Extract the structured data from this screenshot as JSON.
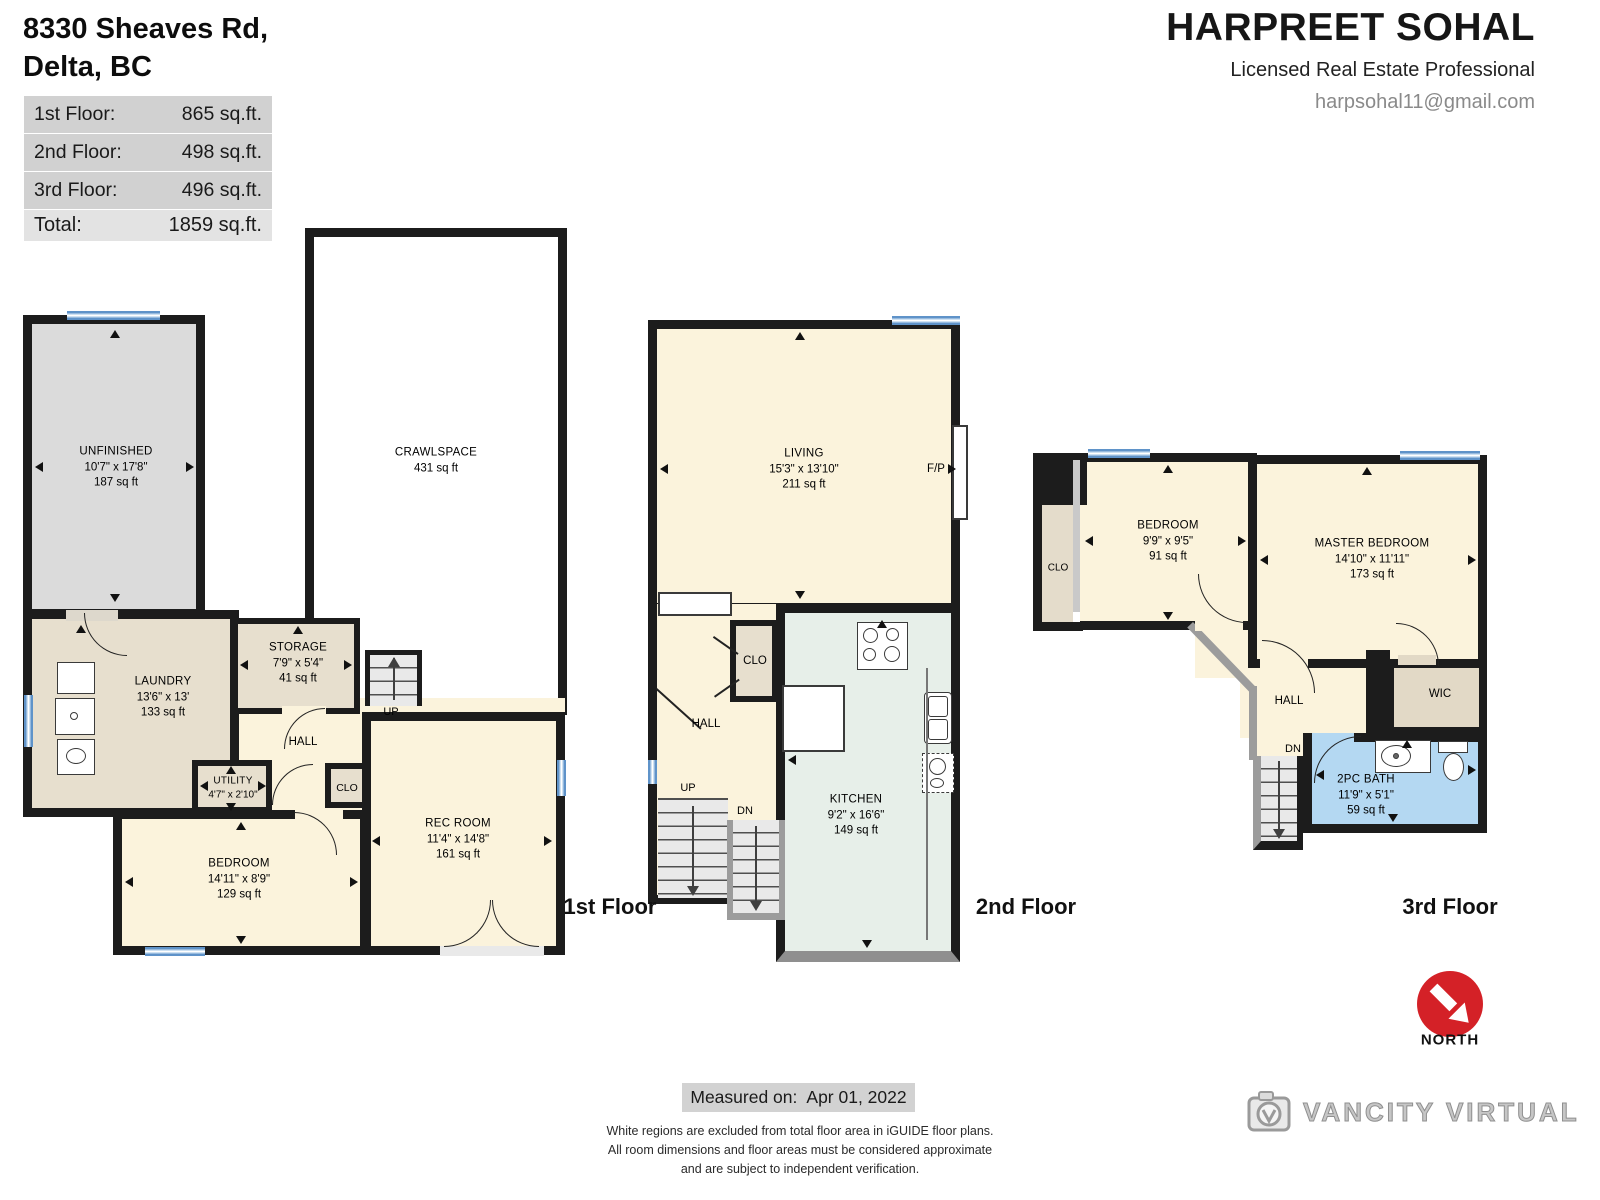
{
  "title": {
    "line1": "8330 Sheaves Rd,",
    "line2": "Delta, BC"
  },
  "area_table": {
    "rows": [
      {
        "label": "1st Floor:",
        "value": "865 sq.ft."
      },
      {
        "label": "2nd Floor:",
        "value": "498 sq.ft."
      },
      {
        "label": "3rd Floor:",
        "value": "496 sq.ft."
      }
    ],
    "total_label": "Total:",
    "total_value": "1859 sq.ft."
  },
  "agent": {
    "name": "HARPREET SOHAL",
    "title": "Licensed Real Estate Professional",
    "email": "harpsohal11@gmail.com"
  },
  "floor1": {
    "label": "1st Floor",
    "rooms": {
      "unfinished": {
        "name": "UNFINISHED",
        "dims": "10'7\" x 17'8\"",
        "area": "187 sq ft"
      },
      "crawlspace": {
        "name": "CRAWLSPACE",
        "area": "431 sq ft"
      },
      "laundry": {
        "name": "LAUNDRY",
        "dims": "13'6\" x 13'",
        "area": "133 sq ft"
      },
      "storage": {
        "name": "STORAGE",
        "dims": "7'9\" x 5'4\"",
        "area": "41 sq ft"
      },
      "utility": {
        "name": "UTILITY",
        "dims": "4'7\" x 2'10\""
      },
      "bedroom": {
        "name": "BEDROOM",
        "dims": "14'11\" x 8'9\"",
        "area": "129 sq ft"
      },
      "recroom": {
        "name": "REC ROOM",
        "dims": "11'4\" x 14'8\"",
        "area": "161 sq ft"
      }
    },
    "labels": {
      "hall": "HALL",
      "clo": "CLO",
      "up": "UP"
    }
  },
  "floor2": {
    "label": "2nd Floor",
    "rooms": {
      "living": {
        "name": "LIVING",
        "dims": "15'3\" x 13'10\"",
        "area": "211 sq ft"
      },
      "kitchen": {
        "name": "KITCHEN",
        "dims": "9'2\" x 16'6\"",
        "area": "149 sq ft"
      }
    },
    "labels": {
      "hall": "HALL",
      "clo": "CLO",
      "up": "UP",
      "dn": "DN",
      "fp": "F/P"
    }
  },
  "floor3": {
    "label": "3rd Floor",
    "rooms": {
      "bedroom": {
        "name": "BEDROOM",
        "dims": "9'9\" x 9'5\"",
        "area": "91 sq ft"
      },
      "master": {
        "name": "MASTER BEDROOM",
        "dims": "14'10\" x 11'11\"",
        "area": "173 sq ft"
      },
      "bath": {
        "name": "2PC BATH",
        "dims": "11'9\" x 5'1\"",
        "area": "59 sq ft"
      }
    },
    "labels": {
      "hall": "HALL",
      "clo": "CLO",
      "wic": "WIC",
      "dn": "DN"
    }
  },
  "compass": {
    "label": "NORTH"
  },
  "footer": {
    "measured_label": "Measured on:",
    "measured_value": "Apr 01, 2022",
    "disclaimer1": "White regions are excluded from total floor area in iGUIDE floor plans.",
    "disclaimer2": "All room dimensions and floor areas must be considered approximate",
    "disclaimer3": "and are subject to independent verification."
  },
  "branding": {
    "logo_text": "VANCITY VIRTUAL"
  },
  "colors": {
    "wall": "#1c1c1c",
    "window_blue": "#6FA0D4",
    "room_cream": "#FBF3DC",
    "room_tan": "#E7DFCE",
    "room_gray": "#DBDBDB",
    "kitchen_green": "#E7EFE9",
    "bath_blue": "#B4D8F2",
    "north_red": "#D42127"
  }
}
